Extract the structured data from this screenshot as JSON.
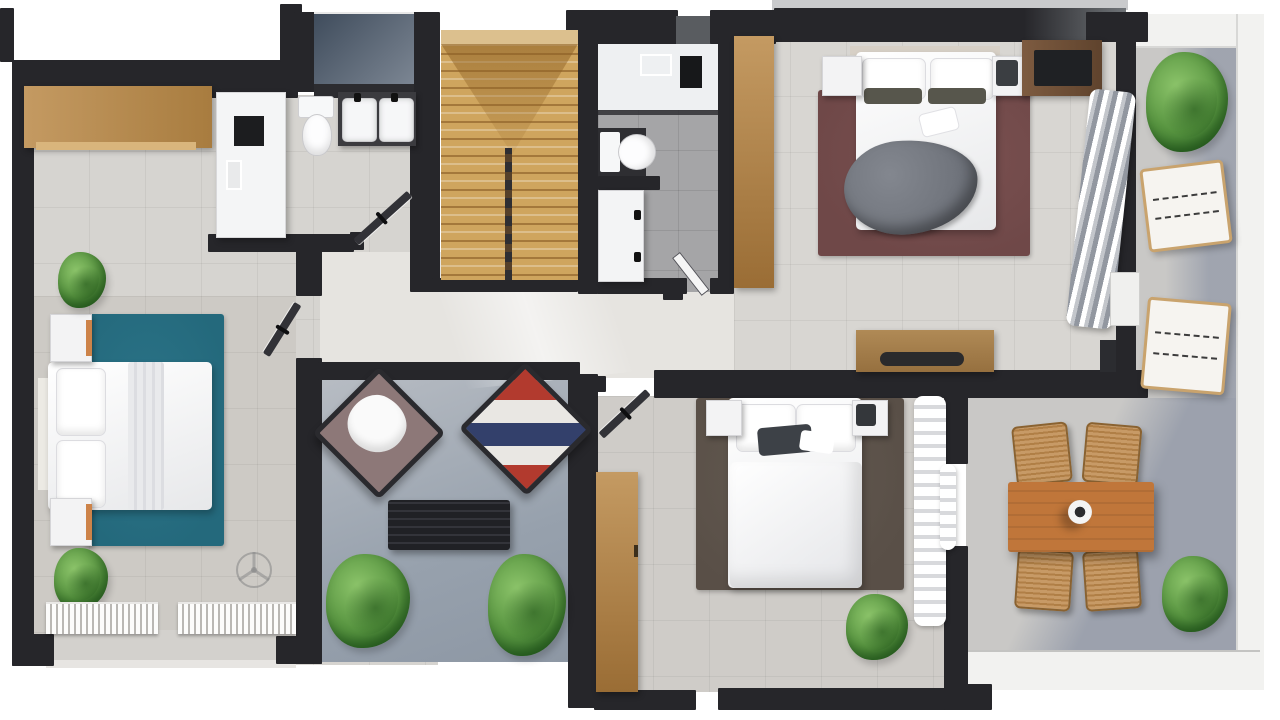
{
  "meta": {
    "kind": "3d-floor-plan-render",
    "view": "top-down apartment / upper floor with terraces",
    "visible_text": "none"
  },
  "palette": {
    "page_bg": "#ffffff",
    "wall": "#26262a",
    "wall_gray": "#595c60",
    "floor_main": "#d6d4d0",
    "floor_master": "#d8d6d2",
    "floor_cbed": "#cfccc8",
    "floor_bath": "#a5a5a7",
    "terrace": "#c9c8c6",
    "parapet": "#f2f2f0",
    "sill": "#d3d1cd",
    "rug_teal": "#24697c",
    "rug_maroon": "#6f4848",
    "rug_taupe": "#594f47",
    "wood_oak": "#c49a62",
    "wood_stairs": "#cfa55e",
    "wood_dark": "#a87c3f",
    "wood_orange": "#c0763a",
    "chair_cane": "#c79a66",
    "plant_light": "#8cc46a",
    "plant_mid": "#56933f",
    "plant_dark": "#2f6b28",
    "white_furn": "#f3f3f4",
    "skylight_a": "#3f4c5c",
    "skylight_b": "#7d8794",
    "tv_dark": "#1f2124",
    "throw_gray": "#6e727a",
    "accent_pillow": "#57564c",
    "accent_orange": "#cd8349",
    "shade_blue": "#5d6b8a"
  },
  "rooms": [
    {
      "name": "utility-room",
      "items": [
        "oak-wardrobe",
        "tall-white-cabinet",
        "toilet",
        "dark-double-basin-vanity",
        "skylight-box"
      ]
    },
    {
      "name": "staircase",
      "items": [
        "winder-stairs",
        "center-stringer-railing"
      ]
    },
    {
      "name": "bathroom",
      "items": [
        "walk-in-shower",
        "shower-mats",
        "toilet",
        "vanity-sink",
        "glass-partition",
        "door"
      ]
    },
    {
      "name": "master-bedroom",
      "items": [
        "double-bed",
        "gray-throw",
        "nightstand-left",
        "nightstand-right",
        "maroon-rug",
        "tv-console",
        "media-sideboard",
        "oak-wardrobe-tall",
        "striped-chaise",
        "end-table"
      ]
    },
    {
      "name": "left-bedroom",
      "items": [
        "double-bed",
        "teal-rug",
        "nightstand-top",
        "nightstand-bottom",
        "plant-top",
        "plant-bottom",
        "louvered-window-wall",
        "ceiling-fan-symbol"
      ]
    },
    {
      "name": "lounge-patio",
      "items": [
        "armchair-white-throw",
        "armchair-patterned",
        "slatted-coffee-table",
        "plant-left",
        "plant-right"
      ]
    },
    {
      "name": "center-bedroom",
      "items": [
        "double-bed",
        "dark-rug",
        "nightstand-left",
        "nightstand-right",
        "oak-wardrobe-tall",
        "curtains",
        "plant"
      ]
    },
    {
      "name": "dining-terrace",
      "items": [
        "wood-dining-table",
        "vase",
        "cane-chair-1",
        "cane-chair-2",
        "cane-chair-3",
        "cane-chair-4",
        "plant"
      ]
    },
    {
      "name": "side-terrace",
      "items": [
        "plant-top",
        "cushioned-stool-1",
        "cushioned-stool-2",
        "parapet",
        "sliding-door"
      ]
    }
  ],
  "icons": [
    {
      "name": "ceiling-fan-icon",
      "meaning": "ceiling fan drawn as translucent circle with blades"
    },
    {
      "name": "door-leaf-icon",
      "meaning": "open door leaf with handle bar"
    }
  ]
}
